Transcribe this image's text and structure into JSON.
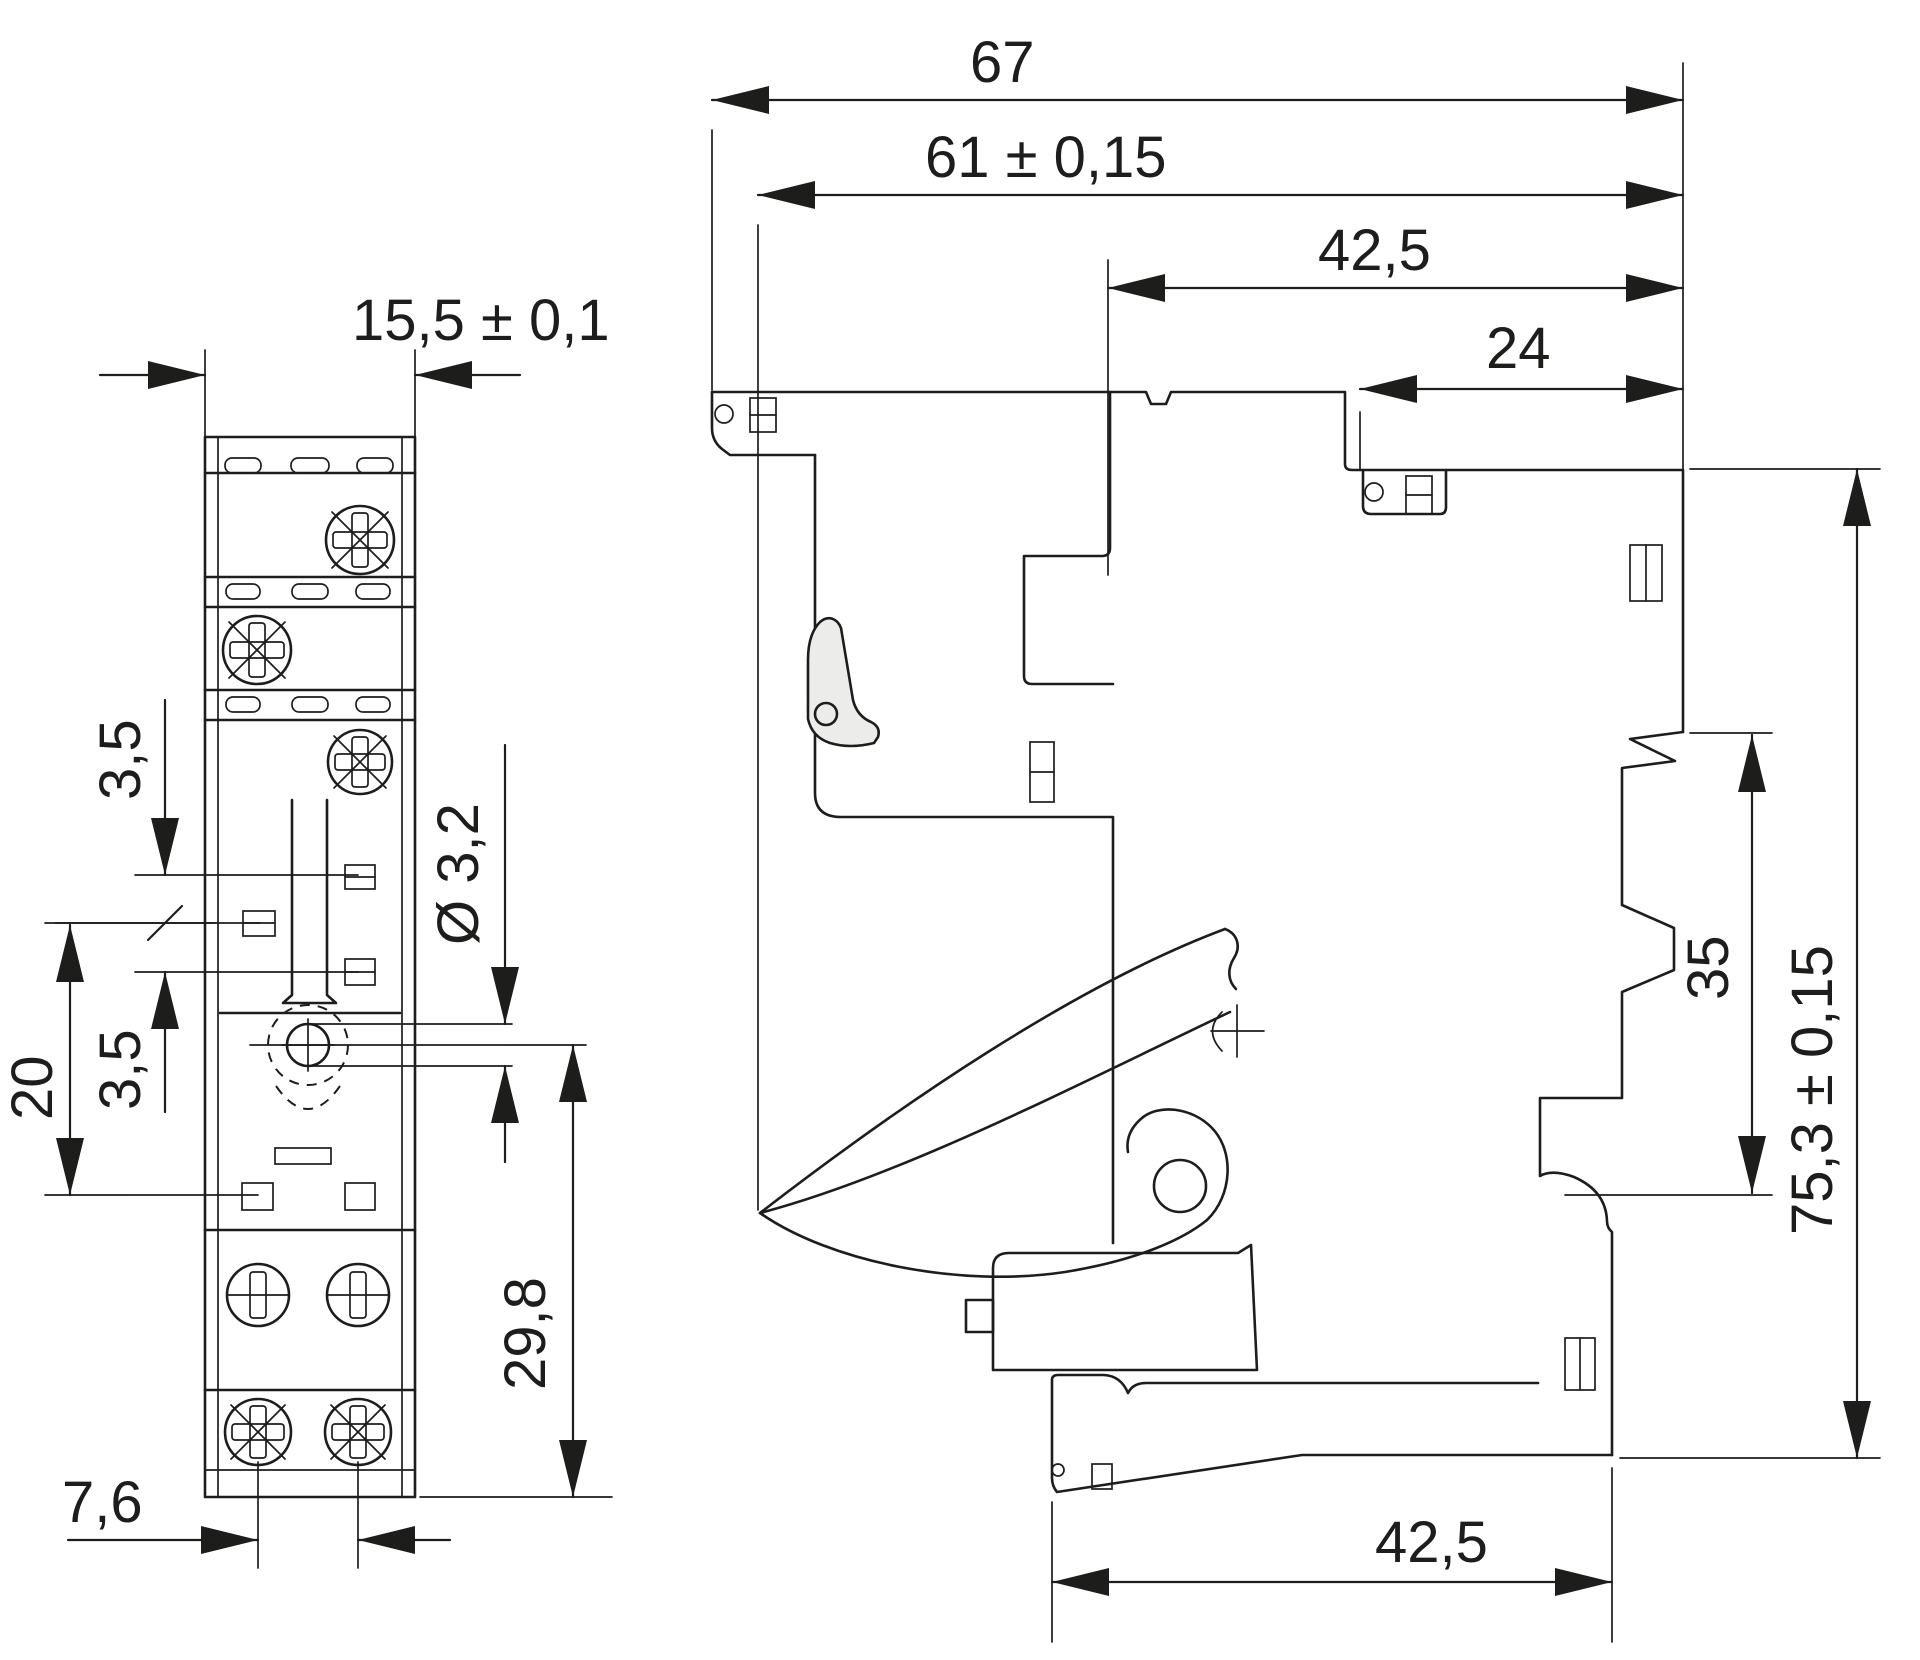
{
  "drawing": {
    "type": "technical-dimension-drawing",
    "subject": "relay-socket",
    "colors": {
      "line": "#1d1d1b",
      "background": "#ffffff",
      "lever_fill": "#ececea"
    }
  },
  "front_view": {
    "name": "front-view",
    "dims": {
      "width": "15,5 ± 0,1",
      "slot_offset_upper": "3,5",
      "slot_offset_lower": "3,5",
      "slot_span": "20",
      "mounting_hole_diameter": "Ø 3,2",
      "hole_to_bottom": "29,8",
      "screw_spacing": "7,6"
    }
  },
  "side_view": {
    "name": "side-view",
    "dims": {
      "total_depth": "67",
      "body_depth": "61 ± 0,15",
      "upper_depth": "42,5",
      "top_depth": "24",
      "din_rail_width": "35",
      "total_height": "75,3 ± 0,15",
      "bottom_depth": "42,5"
    }
  }
}
